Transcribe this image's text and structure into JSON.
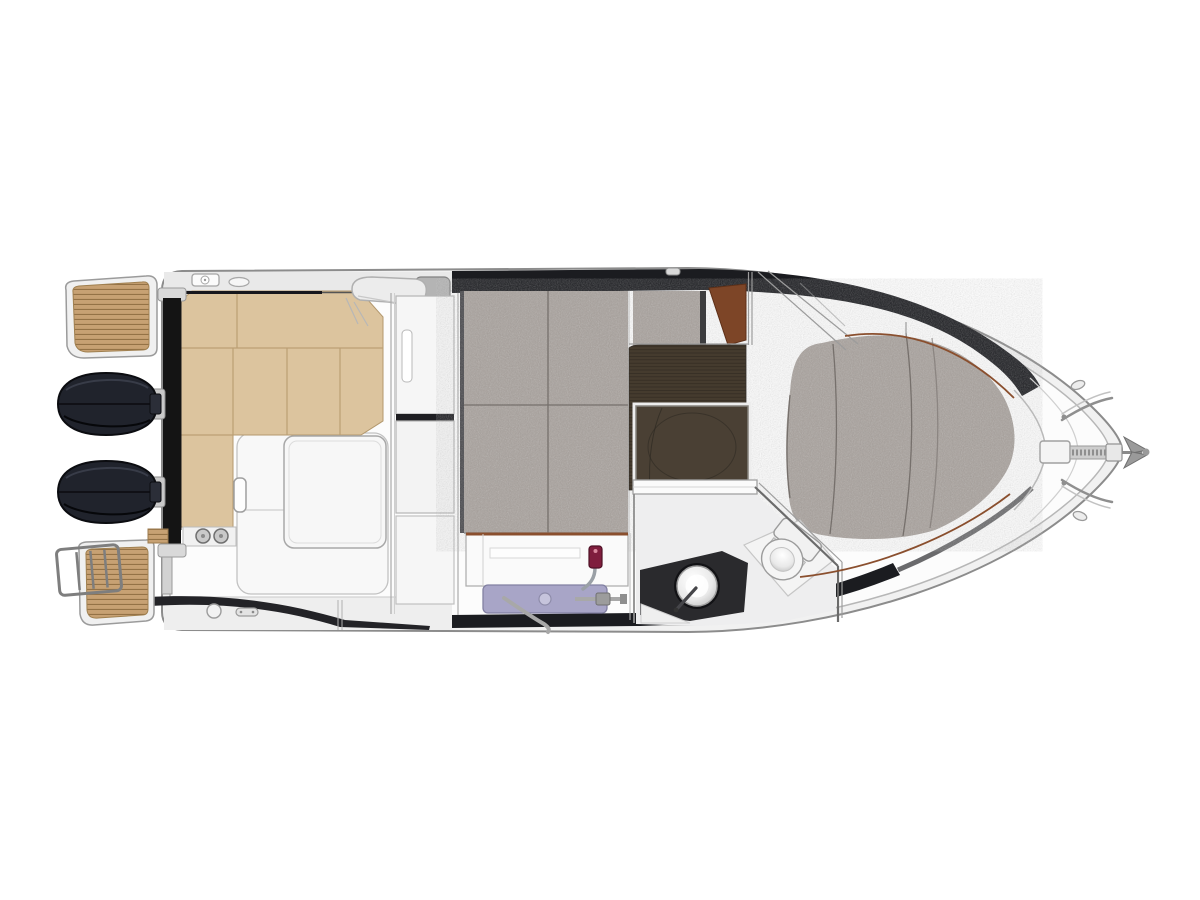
{
  "diagram": {
    "kind": "boat-floor-plan",
    "view": "top-down deck and cabin layout of a motor cruiser",
    "components": {
      "swim_platform_port": "teak swim platform (port)",
      "swim_platform_starboard": "teak swim platform with boarding ladder (starboard)",
      "outboard_engines": "twin outboard engines",
      "cockpit_bench": "L-shaped cockpit bench seating",
      "cockpit_table": "cockpit table",
      "wet_bar": "cockpit wet bar",
      "companionway": "companionway bulkhead and door",
      "mid_cabin_berth": "mid-cabin double berth",
      "helm_seat": "helm seat cushion",
      "wardrobe_panel": "wood wardrobe panel",
      "cabin_floor": "cabin sole (dark wood)",
      "floor_hatch": "floor storage hatch",
      "galley": "galley counter with sink unit and faucet",
      "head": "head compartment with sink and toilet",
      "bow_berth": "island bow berth",
      "anchor_gear": "bow windlass, roller and anchor"
    }
  },
  "colors": {
    "background": "#ffffff",
    "hull_line": "#8c8c8c",
    "hull_inner_line": "#b7b7b7",
    "rim": "#f1f1f1",
    "deck": "#fcfcfc",
    "gunwale": "#e9e9e9",
    "shadow_band": "#1b1c20",
    "dark_band": "#232327",
    "teak": "#c7a173",
    "teak_line": "#8f6d41",
    "platform_frame": "#f0f0f0",
    "engine": "#20232c",
    "engine_edge": "#0b0c10",
    "transom": "#141414",
    "seat": "#dcc49e",
    "seat_seam": "#bb9f74",
    "seat_edge": "#17171c",
    "table": "#f7f7f7",
    "footwell": "#f8f8f8",
    "berth": "#a8a19c",
    "berth_seam": "#76706c",
    "berth_edge": "#46464a",
    "floor": "#453b2e",
    "floor_line": "#2f2920",
    "floor_hatch": "#4a4034",
    "wood": "#7d4527",
    "trim": "#8a4f2e",
    "counter": "#fafafa",
    "galley_unit": "#a8a5c7",
    "galley_unit_line": "#8280a2",
    "hose": "#a8a8a8",
    "faucet": "#7f1d3d",
    "head_floor": "#eeeeef",
    "head_mat": "#2a2a2d",
    "wall": "#6b6b6b",
    "fixture": "#f5f5f5",
    "fixture_line": "#9c9c9c",
    "metal": "#9e9e9e",
    "anchor": "#9a9a9a"
  }
}
